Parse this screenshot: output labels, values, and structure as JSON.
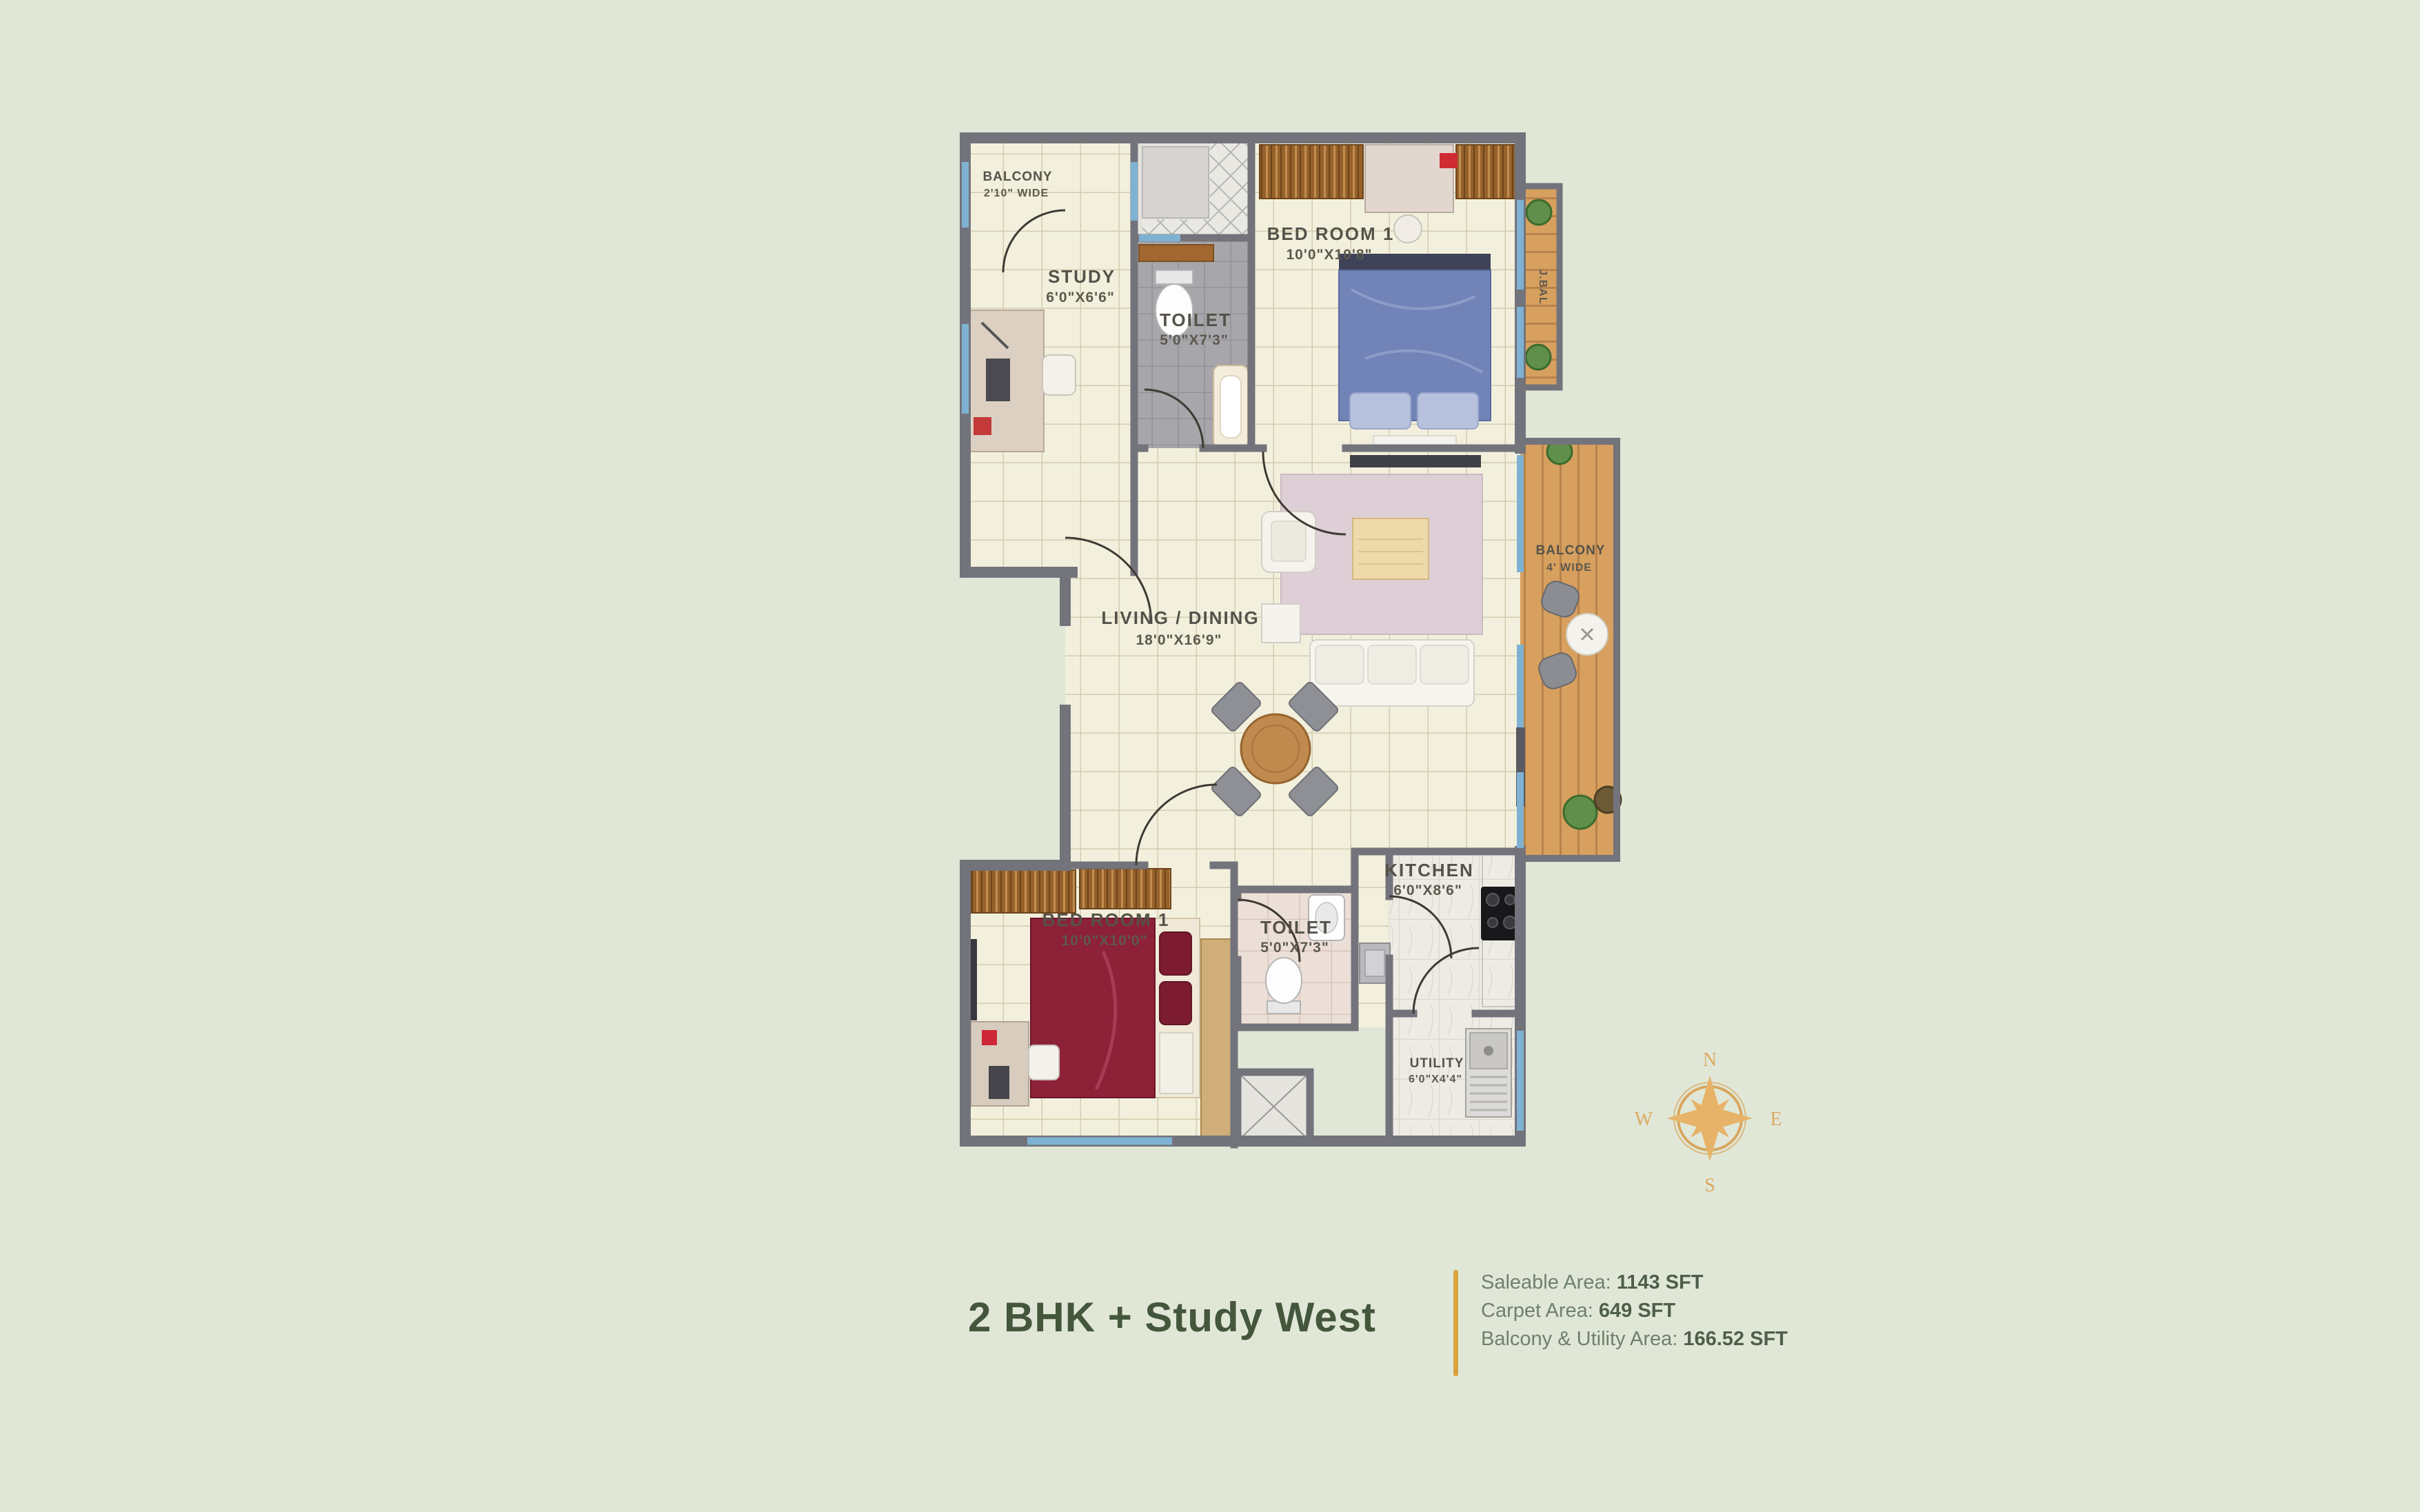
{
  "plan": {
    "rooms": {
      "balcony_top": {
        "name": "BALCONY",
        "dims": "2'10\" WIDE"
      },
      "study": {
        "name": "STUDY",
        "dims": "6'0\"X6'6\""
      },
      "toilet_top": {
        "name": "TOILET",
        "dims": "5'0\"X7'3\""
      },
      "bedroom_top": {
        "name": "BED ROOM 1",
        "dims": "10'0\"X10'8\""
      },
      "jbal": {
        "name": "J.BAL"
      },
      "living": {
        "name": "LIVING / DINING",
        "dims": "18'0\"X16'9\""
      },
      "balcony_right": {
        "name": "BALCONY",
        "dims": "4' WIDE"
      },
      "kitchen": {
        "name": "KITCHEN",
        "dims": "6'0\"X8'6\""
      },
      "toilet_bottom": {
        "name": "TOILET",
        "dims": "5'0\"X7'3\""
      },
      "bedroom_bottom": {
        "name": "BED ROOM 1",
        "dims": "10'0\"X10'0\""
      },
      "utility": {
        "name": "UTILITY",
        "dims": "6'0\"X4'4\""
      }
    },
    "compass": {
      "n": "N",
      "e": "E",
      "s": "S",
      "w": "W"
    },
    "palette": {
      "background": "#e0e7d7",
      "wall": "#73737b",
      "window_blue": "#7fb2d2",
      "deck_wood": "#d7a05e",
      "compass_gold": "#e7b368"
    }
  },
  "footer": {
    "title": "2 BHK + Study West",
    "title_color": "#44563c",
    "accent_color": "#d9a43e",
    "stats": [
      {
        "label": "Saleable Area: ",
        "value": "1143 SFT"
      },
      {
        "label": "Carpet Area: ",
        "value": "649 SFT"
      },
      {
        "label": "Balcony & Utility Area: ",
        "value": "166.52 SFT"
      }
    ]
  }
}
